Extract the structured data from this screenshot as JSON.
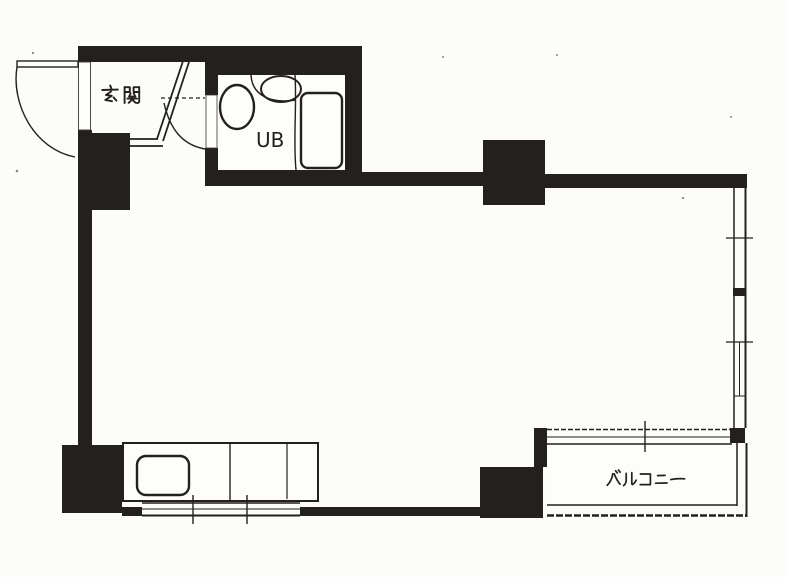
{
  "document": {
    "kind": "scanned apartment floor plan",
    "background": "#fcfcf9",
    "ink": "#24201d"
  },
  "labels": {
    "genkan": "玄関",
    "unit_bath": "UB",
    "balcony": "バルコニー"
  },
  "fixtures": {
    "entry_door": "entry-door-swing",
    "hall_door": "hall-door-swing",
    "toilet": "toilet",
    "washbasin": "washbasin",
    "bathtub": "bathtub",
    "kitchen_counter": "kitchen-counter",
    "kitchen_sink": "kitchen-sink",
    "right_window": "sliding-window",
    "kitchen_window": "kitchen-window",
    "balcony_door": "sliding-glass-door"
  }
}
